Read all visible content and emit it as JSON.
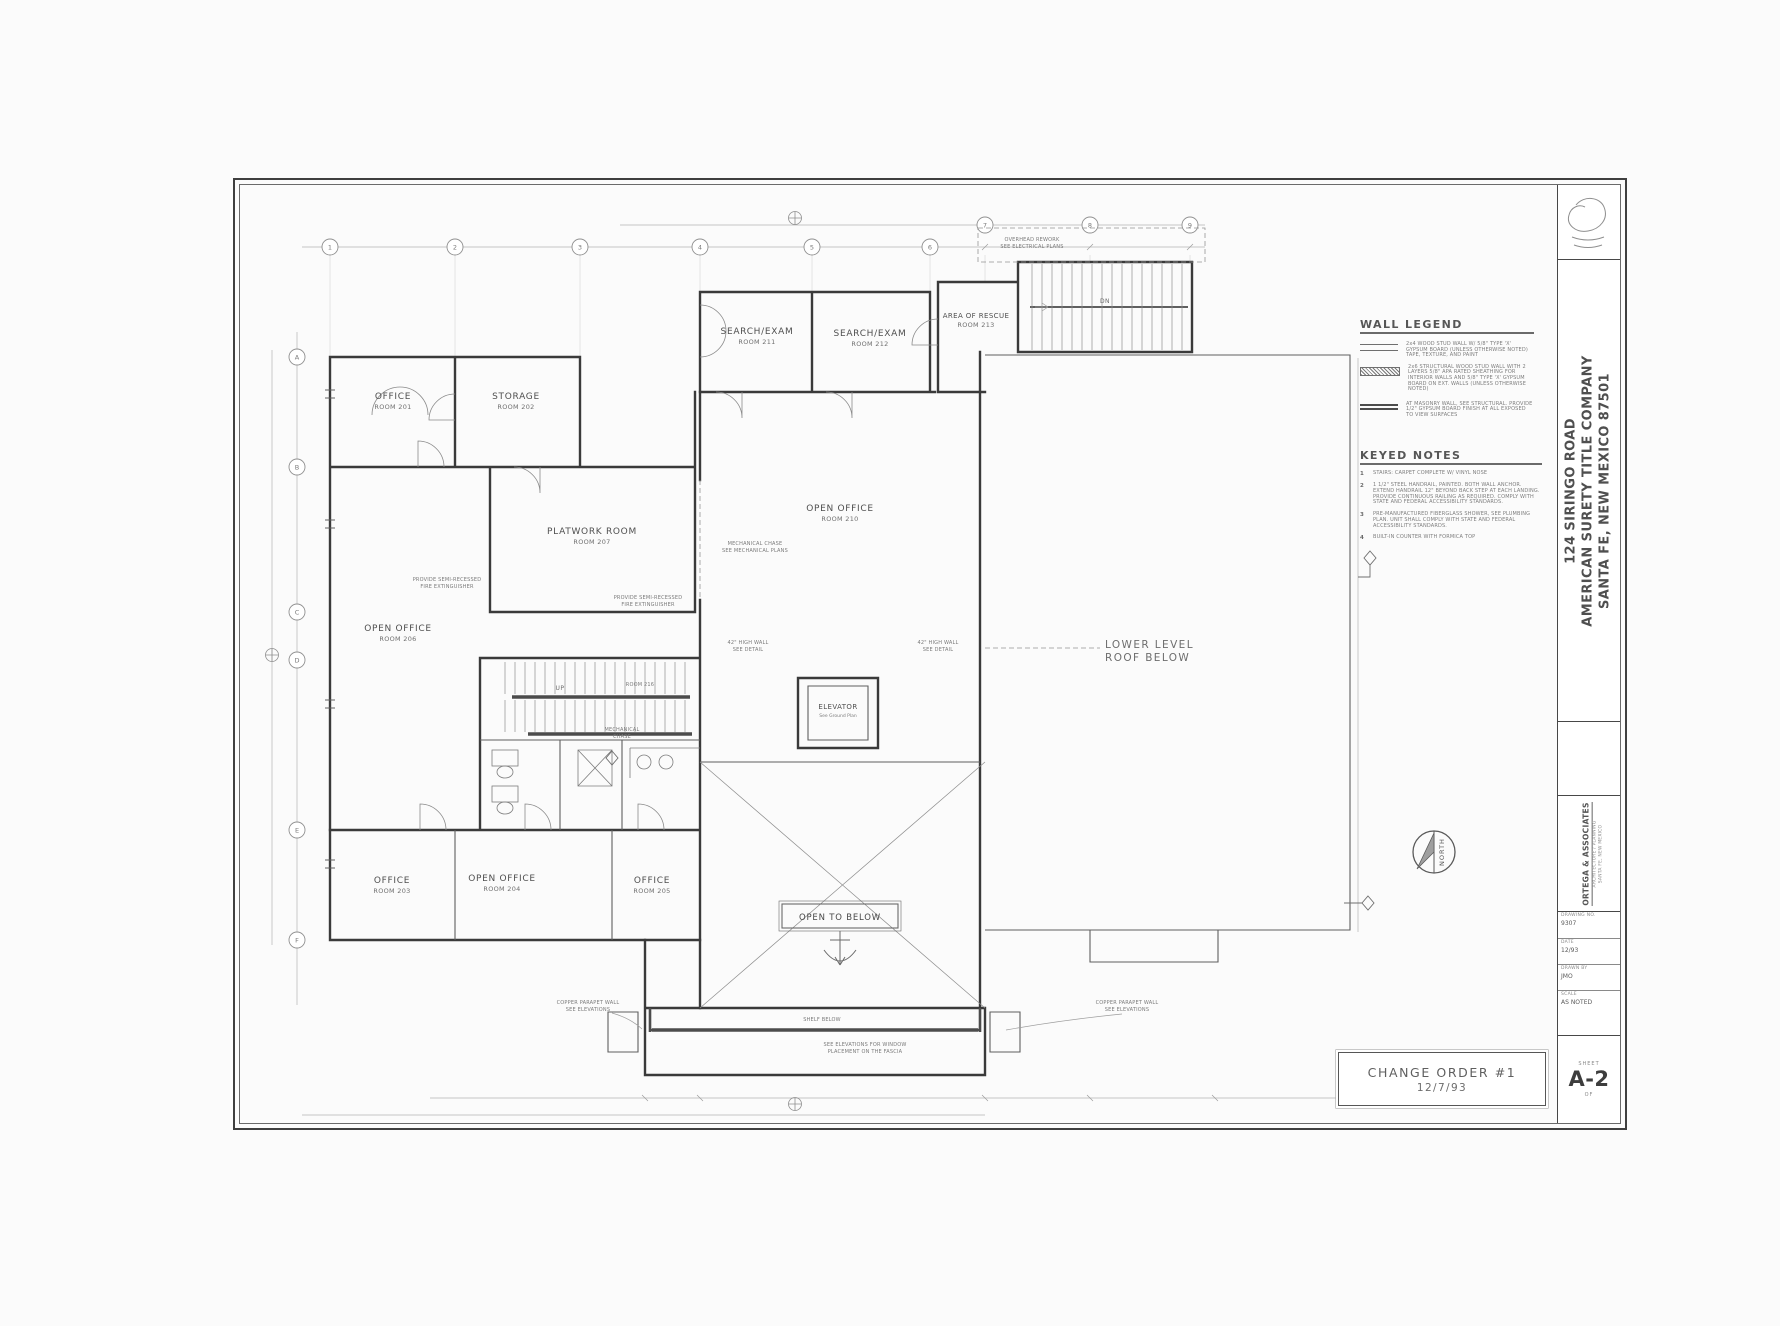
{
  "sheet": {
    "change_order": {
      "title": "CHANGE ORDER #1",
      "date": "12/7/93"
    },
    "title_block": {
      "address": "124 SIRINGO ROAD",
      "company": "AMERICAN SURETY TITLE COMPANY",
      "city": "SANTA FE, NEW MEXICO  87501",
      "firm": "ORTEGA & ASSOCIATES",
      "firm_line1": "ARCHITECTURE / PLANNING",
      "firm_line2": "SANTA FE, NEW MEXICO",
      "rows": [
        {
          "label": "DRAWING NO.",
          "value": "9307"
        },
        {
          "label": "DATE",
          "value": "12/93"
        },
        {
          "label": "DRAWN BY",
          "value": "JMO"
        },
        {
          "label": "SCALE",
          "value": "AS NOTED"
        }
      ],
      "sheet_label": "SHEET",
      "sheet_number": "A-2",
      "of_label": "OF"
    }
  },
  "legend": {
    "title": "WALL LEGEND",
    "items": [
      {
        "desc": "2x4 WOOD STUD WALL W/ 5/8\" TYPE 'X' GYPSUM BOARD (UNLESS OTHERWISE NOTED) TAPE, TEXTURE, AND PAINT"
      },
      {
        "desc": "2x6 STRUCTURAL WOOD STUD WALL WITH 2 LAYERS 5/8\" APA RATED SHEATHING FOR INTERIOR WALLS AND 5/8\" TYPE 'X' GYPSUM BOARD ON EXT. WALLS (UNLESS OTHERWISE NOTED)"
      },
      {
        "desc": "AT MASONRY WALL, SEE STRUCTURAL. PROVIDE 1/2\" GYPSUM BOARD FINISH AT ALL EXPOSED TO VIEW SURFACES"
      }
    ]
  },
  "keyed_notes": {
    "title": "KEYED NOTES",
    "items": [
      {
        "num": "1",
        "text": "STAIRS: CARPET COMPLETE W/ VINYL NOSE"
      },
      {
        "num": "2",
        "text": "1 1/2\" STEEL HANDRAIL, PAINTED. BOTH WALL ANCHOR. EXTEND HANDRAIL 12\" BEYOND BACK STEP AT EACH LANDING. PROVIDE CONTINUOUS RAILING AS REQUIRED. COMPLY WITH STATE AND FEDERAL ACCESSIBILITY STANDARDS."
      },
      {
        "num": "3",
        "text": "PRE-MANUFACTURED FIBERGLASS SHOWER, SEE PLUMBING PLAN. UNIT SHALL COMPLY WITH STATE AND FEDERAL ACCESSIBILITY STANDARDS."
      },
      {
        "num": "4",
        "text": "BUILT-IN COUNTER WITH FORMICA TOP"
      }
    ]
  },
  "plan": {
    "rooms": [
      {
        "name": "OFFICE",
        "num": "ROOM 201"
      },
      {
        "name": "STORAGE",
        "num": "ROOM 202"
      },
      {
        "name": "PLATWORK ROOM",
        "num": "ROOM 207"
      },
      {
        "name": "OPEN OFFICE",
        "num": "ROOM 206"
      },
      {
        "name": "SEARCH/EXAM",
        "num": "ROOM 211"
      },
      {
        "name": "SEARCH/EXAM",
        "num": "ROOM 212"
      },
      {
        "name": "AREA OF RESCUE",
        "num": "ROOM 213"
      },
      {
        "name": "OPEN OFFICE",
        "num": "ROOM 210"
      },
      {
        "name": "ELEVATOR",
        "num": "See Ground Plan"
      },
      {
        "name": "LOWER LEVEL",
        "num": "ROOF BELOW"
      },
      {
        "name": "OFFICE",
        "num": "ROOM 203"
      },
      {
        "name": "OPEN OFFICE",
        "num": "ROOM 204"
      },
      {
        "name": "OFFICE",
        "num": "ROOM 205"
      }
    ],
    "open_to_below": "OPEN TO BELOW",
    "stair_dn": "DN",
    "stair_up": "UP",
    "notes": [
      {
        "l1": "OVERHEAD REWORK",
        "l2": "SEE ELECTRICAL PLANS"
      },
      {
        "l1": "MECHANICAL CHASE",
        "l2": "SEE MECHANICAL PLANS"
      },
      {
        "l1": "PROVIDE SEMI-RECESSED",
        "l2": "FIRE EXTINGUISHER"
      },
      {
        "l1": "PROVIDE SEMI-RECESSED",
        "l2": "FIRE EXTINGUISHER"
      },
      {
        "l1": "MECHANICAL",
        "l2": "CHASE"
      },
      {
        "l1": "ROOM 216",
        "l2": ""
      },
      {
        "l1": "COPPER PARAPET WALL",
        "l2": "SEE ELEVATIONS"
      },
      {
        "l1": "COPPER PARAPET WALL",
        "l2": "SEE ELEVATIONS"
      },
      {
        "l1": "SHELF BELOW",
        "l2": ""
      },
      {
        "l1": "SEE ELEVATIONS FOR WINDOW",
        "l2": "PLACEMENT ON THE FASCIA"
      },
      {
        "l1": "42\" HIGH WALL",
        "l2": "SEE DETAIL"
      },
      {
        "l1": "42\" HIGH WALL",
        "l2": "SEE DETAIL"
      }
    ]
  },
  "grid": {
    "top": [
      "1",
      "2",
      "3",
      "4",
      "5",
      "6",
      "7",
      "8",
      "9"
    ],
    "left": [
      "A",
      "B",
      "C",
      "D",
      "E",
      "F"
    ]
  },
  "north": {
    "label": "NORTH"
  }
}
